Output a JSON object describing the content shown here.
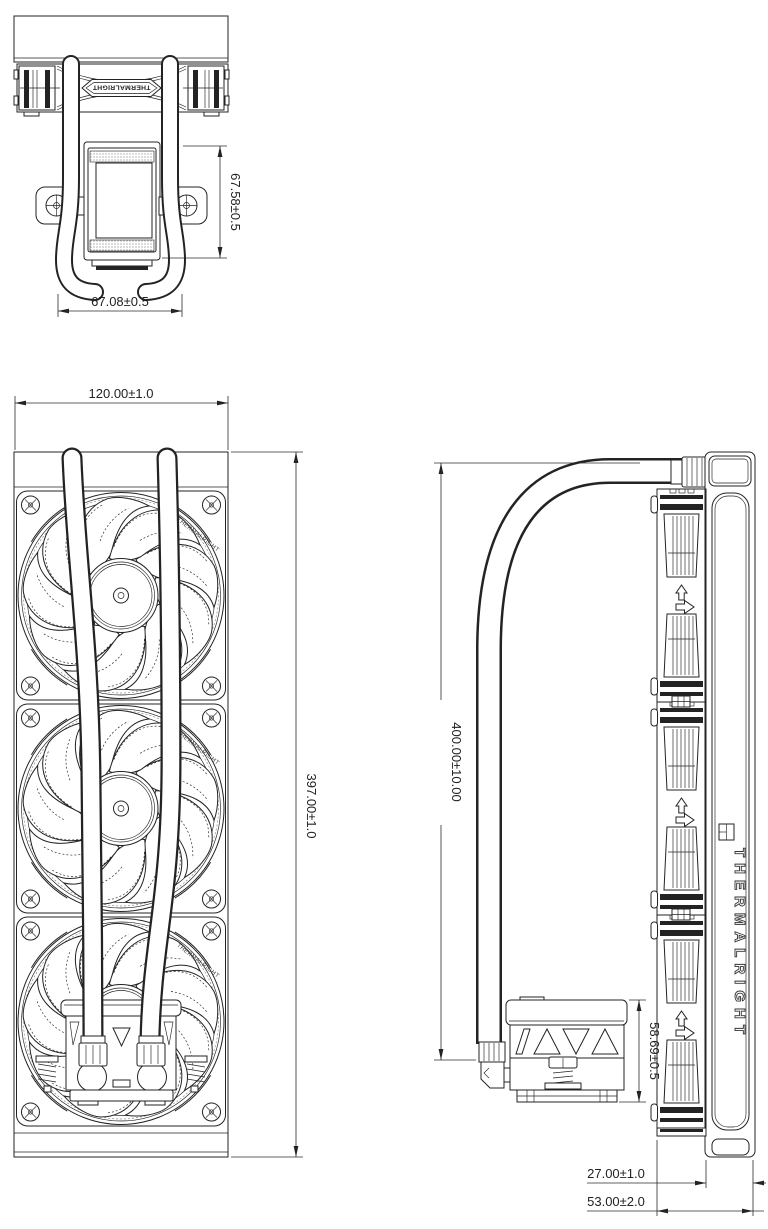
{
  "page": {
    "background": "#ffffff",
    "line_color": "#232323",
    "drawing_type": "AIO liquid cooler dimension drawing"
  },
  "branding": {
    "fan_badge": "THERMALRIGHT",
    "radiator_side_label": "THERMALRIGHT",
    "fan_rim_label": "THERMALRIGHT"
  },
  "dimensions": {
    "pump_height": "67.58±0.5",
    "pump_width": "67.08±0.5",
    "radiator_width": "120.00±1.0",
    "radiator_length": "397.00±1.0",
    "tube_length": "400.00±10.00",
    "pump_block_height": "58.69±0.5",
    "radiator_thickness": "27.00±1.0",
    "total_thickness": "53.00±2.0"
  }
}
